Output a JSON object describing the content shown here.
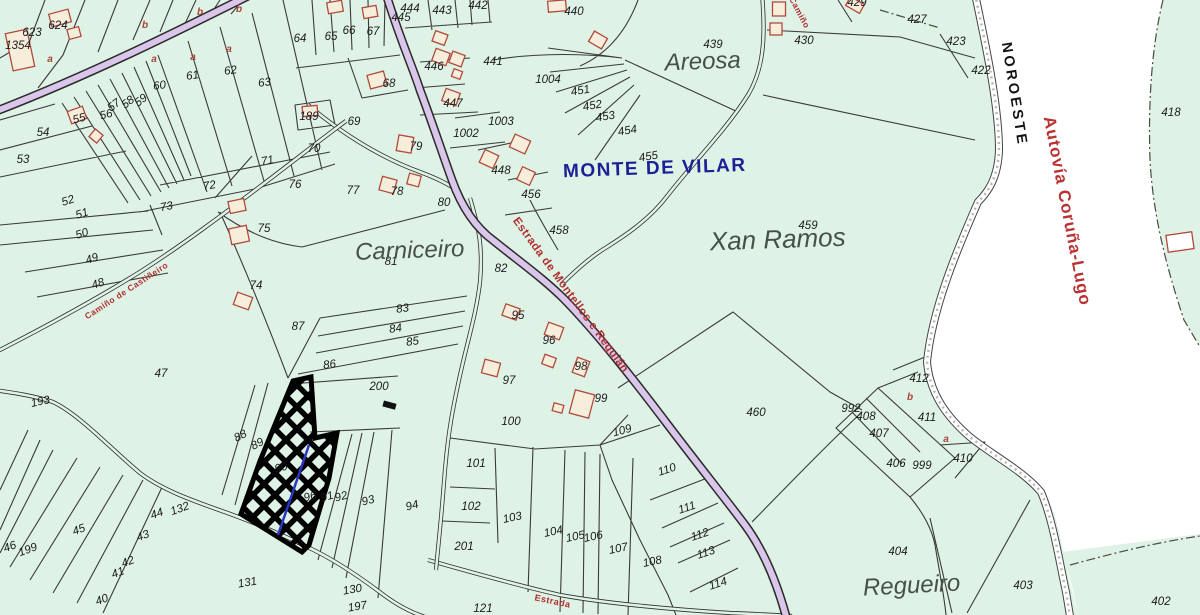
{
  "map": {
    "colors": {
      "land": "#dff2e6",
      "corridor": "#ffffff",
      "road_fill": "#d9c6ea",
      "boundary": "#3a3a3a",
      "district_text": "#1c1f96",
      "highway_text": "#b83232",
      "road_label_text": "#b03030",
      "building_stroke": "#b24a3c",
      "building_fill": "#f6eedb",
      "selection_outline": "#000000",
      "selection_inner_line": "#2a35c0"
    },
    "district_label": {
      "text": "MONTE DE VILAR",
      "x": 655,
      "y": 174,
      "r": -2
    },
    "direction_label": {
      "text": "NOROESTE",
      "x": 1010,
      "y": 95,
      "r": 81
    },
    "highway_label": {
      "text": "Autovía Coruña-Lugo",
      "x": 1062,
      "y": 212,
      "r": 79
    },
    "place_labels": [
      {
        "text": "Carniceiro",
        "x": 410,
        "y": 258,
        "r": -2,
        "size": 24
      },
      {
        "text": "Areosa",
        "x": 703,
        "y": 69,
        "r": -2,
        "size": 24
      },
      {
        "text": "Xan Ramos",
        "x": 778,
        "y": 248,
        "r": -2,
        "size": 26
      },
      {
        "text": "Regueiro",
        "x": 912,
        "y": 593,
        "r": -3,
        "size": 24
      }
    ],
    "road_labels": [
      {
        "text": "Estrada de Montellos e Requián",
        "x": 568,
        "y": 297,
        "r": 54,
        "size": 11.5
      },
      {
        "text": "Camiño de Castiñeiro",
        "x": 128,
        "y": 293,
        "r": -33,
        "size": 8.5
      },
      {
        "text": "Camiño",
        "x": 797,
        "y": 14,
        "r": 62,
        "size": 8.5
      },
      {
        "text": "Estrada",
        "x": 552,
        "y": 604,
        "r": 12,
        "size": 9
      }
    ],
    "selected_parcel": "90",
    "subdivision_letters": [
      {
        "t": "a",
        "x": 50,
        "y": 62
      },
      {
        "t": "b",
        "x": 145,
        "y": 28
      },
      {
        "t": "b",
        "x": 200,
        "y": 15
      },
      {
        "t": "b",
        "x": 239,
        "y": 12
      },
      {
        "t": "a",
        "x": 154,
        "y": 62
      },
      {
        "t": "a",
        "x": 193,
        "y": 60
      },
      {
        "t": "a",
        "x": 229,
        "y": 52
      },
      {
        "t": "b",
        "x": 910,
        "y": 400
      },
      {
        "t": "a",
        "x": 946,
        "y": 442
      }
    ],
    "parcel_numbers": [
      {
        "n": "623",
        "x": 32,
        "y": 36
      },
      {
        "n": "624",
        "x": 58,
        "y": 29
      },
      {
        "n": "1354",
        "x": 18,
        "y": 49
      },
      {
        "n": "53",
        "x": 23,
        "y": 163
      },
      {
        "n": "54",
        "x": 43,
        "y": 136
      },
      {
        "n": "55",
        "x": 80,
        "y": 122,
        "r": -15
      },
      {
        "n": "56",
        "x": 107,
        "y": 118,
        "r": -15
      },
      {
        "n": "57",
        "x": 116,
        "y": 108,
        "r": -38
      },
      {
        "n": "58",
        "x": 130,
        "y": 105,
        "r": -38
      },
      {
        "n": "59",
        "x": 143,
        "y": 103,
        "r": -38
      },
      {
        "n": "60",
        "x": 160,
        "y": 89,
        "r": -8
      },
      {
        "n": "61",
        "x": 193,
        "y": 79,
        "r": -8
      },
      {
        "n": "62",
        "x": 231,
        "y": 74,
        "r": -8
      },
      {
        "n": "63",
        "x": 265,
        "y": 86,
        "r": -8
      },
      {
        "n": "64",
        "x": 300,
        "y": 42
      },
      {
        "n": "65",
        "x": 331,
        "y": 40
      },
      {
        "n": "66",
        "x": 349,
        "y": 34
      },
      {
        "n": "67",
        "x": 373,
        "y": 35
      },
      {
        "n": "68",
        "x": 389,
        "y": 87
      },
      {
        "n": "69",
        "x": 354,
        "y": 125
      },
      {
        "n": "70",
        "x": 314,
        "y": 152
      },
      {
        "n": "189",
        "x": 309,
        "y": 120
      },
      {
        "n": "71",
        "x": 268,
        "y": 164,
        "r": -10
      },
      {
        "n": "72",
        "x": 210,
        "y": 189,
        "r": -10
      },
      {
        "n": "73",
        "x": 167,
        "y": 210,
        "r": -10
      },
      {
        "n": "74",
        "x": 256,
        "y": 289
      },
      {
        "n": "75",
        "x": 264,
        "y": 232
      },
      {
        "n": "76",
        "x": 295,
        "y": 188
      },
      {
        "n": "77",
        "x": 353,
        "y": 194
      },
      {
        "n": "78",
        "x": 397,
        "y": 195
      },
      {
        "n": "79",
        "x": 416,
        "y": 150
      },
      {
        "n": "80",
        "x": 444,
        "y": 206
      },
      {
        "n": "81",
        "x": 391,
        "y": 265
      },
      {
        "n": "82",
        "x": 501,
        "y": 272
      },
      {
        "n": "83",
        "x": 403,
        "y": 312,
        "r": -8
      },
      {
        "n": "84",
        "x": 396,
        "y": 332,
        "r": -8
      },
      {
        "n": "85",
        "x": 413,
        "y": 345,
        "r": -8
      },
      {
        "n": "86",
        "x": 330,
        "y": 368,
        "r": -8
      },
      {
        "n": "87",
        "x": 298,
        "y": 330
      },
      {
        "n": "200",
        "x": 379,
        "y": 390
      },
      {
        "n": "47",
        "x": 161,
        "y": 377
      },
      {
        "n": "193",
        "x": 41,
        "y": 405,
        "r": -12
      },
      {
        "n": "48",
        "x": 99,
        "y": 287,
        "r": -18
      },
      {
        "n": "49",
        "x": 93,
        "y": 262,
        "r": -18
      },
      {
        "n": "50",
        "x": 83,
        "y": 237,
        "r": -18
      },
      {
        "n": "51",
        "x": 83,
        "y": 217,
        "r": -18
      },
      {
        "n": "52",
        "x": 69,
        "y": 204,
        "r": -18
      },
      {
        "n": "88",
        "x": 242,
        "y": 439,
        "r": -28
      },
      {
        "n": "89",
        "x": 259,
        "y": 447,
        "r": -28
      },
      {
        "n": "90",
        "x": 282,
        "y": 471,
        "r": -15
      },
      {
        "n": "96",
        "x": 311,
        "y": 500,
        "r": -15
      },
      {
        "n": "91",
        "x": 328,
        "y": 500,
        "r": -15
      },
      {
        "n": "92",
        "x": 342,
        "y": 500,
        "r": -15
      },
      {
        "n": "93",
        "x": 369,
        "y": 504,
        "r": -15
      },
      {
        "n": "94",
        "x": 413,
        "y": 509,
        "r": -15
      },
      {
        "n": "44",
        "x": 158,
        "y": 517,
        "r": -20
      },
      {
        "n": "132",
        "x": 181,
        "y": 512,
        "r": -20
      },
      {
        "n": "43",
        "x": 144,
        "y": 539,
        "r": -20
      },
      {
        "n": "42",
        "x": 129,
        "y": 565,
        "r": -20
      },
      {
        "n": "41",
        "x": 119,
        "y": 576,
        "r": -20
      },
      {
        "n": "40",
        "x": 103,
        "y": 603,
        "r": -20
      },
      {
        "n": "45",
        "x": 80,
        "y": 533,
        "r": -20
      },
      {
        "n": "46",
        "x": 11,
        "y": 550,
        "r": -20
      },
      {
        "n": "199",
        "x": 29,
        "y": 553,
        "r": -20
      },
      {
        "n": "131",
        "x": 248,
        "y": 586,
        "r": -10
      },
      {
        "n": "130",
        "x": 353,
        "y": 593,
        "r": -10
      },
      {
        "n": "197",
        "x": 358,
        "y": 610,
        "r": -10
      },
      {
        "n": "121",
        "x": 483,
        "y": 612
      },
      {
        "n": "100",
        "x": 511,
        "y": 425
      },
      {
        "n": "101",
        "x": 476,
        "y": 467
      },
      {
        "n": "102",
        "x": 471,
        "y": 510
      },
      {
        "n": "201",
        "x": 464,
        "y": 550
      },
      {
        "n": "103",
        "x": 513,
        "y": 521,
        "r": -12
      },
      {
        "n": "104",
        "x": 554,
        "y": 535,
        "r": -12
      },
      {
        "n": "105",
        "x": 576,
        "y": 540,
        "r": -12
      },
      {
        "n": "106",
        "x": 594,
        "y": 540,
        "r": -12
      },
      {
        "n": "107",
        "x": 619,
        "y": 552,
        "r": -12
      },
      {
        "n": "108",
        "x": 653,
        "y": 565,
        "r": -12
      },
      {
        "n": "109",
        "x": 623,
        "y": 434,
        "r": -15
      },
      {
        "n": "110",
        "x": 668,
        "y": 473,
        "r": -18
      },
      {
        "n": "111",
        "x": 688,
        "y": 511,
        "r": -18
      },
      {
        "n": "112",
        "x": 701,
        "y": 538,
        "r": -18
      },
      {
        "n": "113",
        "x": 707,
        "y": 556,
        "r": -18
      },
      {
        "n": "114",
        "x": 719,
        "y": 587,
        "r": -18
      },
      {
        "n": "95",
        "x": 518,
        "y": 319
      },
      {
        "n": "96",
        "x": 549,
        "y": 344
      },
      {
        "n": "97",
        "x": 509,
        "y": 384
      },
      {
        "n": "98",
        "x": 581,
        "y": 370
      },
      {
        "n": "99",
        "x": 601,
        "y": 402
      },
      {
        "n": "1002",
        "x": 466,
        "y": 137
      },
      {
        "n": "1003",
        "x": 501,
        "y": 125
      },
      {
        "n": "1004",
        "x": 548,
        "y": 83
      },
      {
        "n": "451",
        "x": 581,
        "y": 94,
        "r": -10
      },
      {
        "n": "452",
        "x": 593,
        "y": 109,
        "r": -10
      },
      {
        "n": "453",
        "x": 606,
        "y": 120,
        "r": -10
      },
      {
        "n": "454",
        "x": 628,
        "y": 134,
        "r": -10
      },
      {
        "n": "455",
        "x": 649,
        "y": 160,
        "r": -10
      },
      {
        "n": "439",
        "x": 713,
        "y": 48
      },
      {
        "n": "440",
        "x": 574,
        "y": 15
      },
      {
        "n": "441",
        "x": 493,
        "y": 65
      },
      {
        "n": "442",
        "x": 478,
        "y": 9
      },
      {
        "n": "443",
        "x": 442,
        "y": 14
      },
      {
        "n": "444",
        "x": 410,
        "y": 12
      },
      {
        "n": "445",
        "x": 401,
        "y": 21
      },
      {
        "n": "446",
        "x": 434,
        "y": 70
      },
      {
        "n": "447",
        "x": 453,
        "y": 107
      },
      {
        "n": "448",
        "x": 501,
        "y": 174
      },
      {
        "n": "456",
        "x": 531,
        "y": 198
      },
      {
        "n": "458",
        "x": 559,
        "y": 234
      },
      {
        "n": "459",
        "x": 808,
        "y": 229
      },
      {
        "n": "460",
        "x": 756,
        "y": 416
      },
      {
        "n": "429",
        "x": 857,
        "y": 6
      },
      {
        "n": "427",
        "x": 917,
        "y": 23
      },
      {
        "n": "430",
        "x": 804,
        "y": 44
      },
      {
        "n": "423",
        "x": 956,
        "y": 45
      },
      {
        "n": "422",
        "x": 981,
        "y": 74
      },
      {
        "n": "418",
        "x": 1171,
        "y": 116
      },
      {
        "n": "412",
        "x": 919,
        "y": 382
      },
      {
        "n": "992",
        "x": 851,
        "y": 412
      },
      {
        "n": "408",
        "x": 866,
        "y": 420
      },
      {
        "n": "407",
        "x": 879,
        "y": 437
      },
      {
        "n": "406",
        "x": 896,
        "y": 467
      },
      {
        "n": "999",
        "x": 922,
        "y": 469
      },
      {
        "n": "411",
        "x": 927,
        "y": 421
      },
      {
        "n": "410",
        "x": 963,
        "y": 462
      },
      {
        "n": "404",
        "x": 898,
        "y": 555
      },
      {
        "n": "403",
        "x": 1023,
        "y": 589
      },
      {
        "n": "402",
        "x": 1161,
        "y": 605
      }
    ],
    "buildings": [
      [
        20,
        50,
        22,
        38,
        -12
      ],
      [
        60,
        18,
        20,
        13,
        -15
      ],
      [
        74,
        33,
        12,
        10,
        -15
      ],
      [
        77,
        115,
        16,
        13,
        -20
      ],
      [
        96,
        136,
        10,
        10,
        40
      ],
      [
        237,
        206,
        16,
        12,
        -12
      ],
      [
        239,
        235,
        18,
        16,
        -12
      ],
      [
        243,
        301,
        16,
        13,
        20
      ],
      [
        335,
        7,
        15,
        11,
        -10
      ],
      [
        370,
        12,
        14,
        11,
        -10
      ],
      [
        440,
        38,
        13,
        11,
        20
      ],
      [
        441,
        57,
        15,
        13,
        20
      ],
      [
        457,
        59,
        13,
        12,
        20
      ],
      [
        451,
        97,
        15,
        13,
        20
      ],
      [
        457,
        74,
        9,
        8,
        20
      ],
      [
        377,
        80,
        17,
        14,
        -15
      ],
      [
        310,
        111,
        15,
        10,
        -5
      ],
      [
        405,
        144,
        15,
        16,
        10
      ],
      [
        388,
        185,
        15,
        14,
        15
      ],
      [
        414,
        180,
        12,
        11,
        15
      ],
      [
        489,
        159,
        15,
        14,
        25
      ],
      [
        520,
        144,
        17,
        14,
        25
      ],
      [
        526,
        176,
        14,
        14,
        25
      ],
      [
        557,
        6,
        18,
        11,
        -5
      ],
      [
        598,
        40,
        15,
        12,
        30
      ],
      [
        511,
        312,
        15,
        12,
        20
      ],
      [
        554,
        331,
        16,
        13,
        20
      ],
      [
        549,
        361,
        12,
        10,
        20
      ],
      [
        491,
        368,
        16,
        14,
        15
      ],
      [
        558,
        408,
        10,
        8,
        15
      ],
      [
        581,
        367,
        13,
        16,
        20
      ],
      [
        582,
        404,
        20,
        24,
        15
      ],
      [
        779,
        9,
        13,
        14,
        0
      ],
      [
        776,
        29,
        12,
        12,
        0
      ],
      [
        855,
        5,
        16,
        10,
        30
      ],
      [
        1180,
        242,
        26,
        17,
        -8,
        1
      ]
    ]
  }
}
